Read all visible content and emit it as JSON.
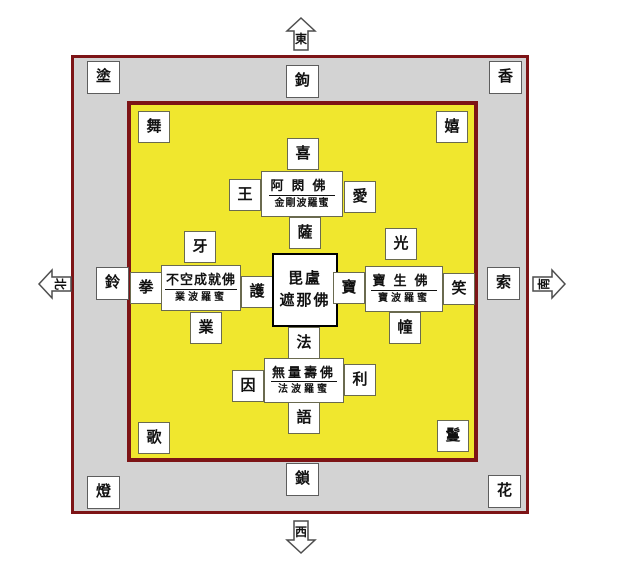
{
  "colors": {
    "courtyard_border": "#7d1416",
    "outer_band_fill": "#d3d3d3",
    "inner_court_fill": "#f0e72e",
    "box_fill": "#ffffff",
    "text": "#111111"
  },
  "compass": {
    "top": "東",
    "bottom": "西",
    "left": "北",
    "right": "南"
  },
  "outer_band": {
    "corner_top_left": "塗",
    "corner_top_right": "香",
    "corner_bottom_left": "燈",
    "corner_bottom_right": "花",
    "edge_top": "鉤",
    "edge_right": "索",
    "edge_bottom": "鎖",
    "edge_left": "鈴"
  },
  "inner_corners": {
    "top_left": "舞",
    "top_right": "嬉",
    "bottom_left": "歌",
    "bottom_right": "鬘"
  },
  "center_buddha": {
    "line1": "毘盧",
    "line2": "遮那佛"
  },
  "buddha_groups": {
    "top": {
      "name": "阿閦佛",
      "paramita": "金剛波羅蜜",
      "satellite_top": "喜",
      "satellite_left": "王",
      "satellite_right": "愛",
      "satellite_bottom": "薩"
    },
    "right": {
      "name": "寶生佛",
      "paramita": "寶波羅蜜",
      "satellite_top": "光",
      "satellite_left": "寶",
      "satellite_right": "笑",
      "satellite_bottom": "幢"
    },
    "bottom": {
      "name": "無量壽佛",
      "paramita": "法波羅蜜",
      "satellite_top": "法",
      "satellite_left": "因",
      "satellite_right": "利",
      "satellite_bottom": "語"
    },
    "left": {
      "name": "不空成就佛",
      "paramita": "業波羅蜜",
      "satellite_top": "牙",
      "satellite_left": "拳",
      "satellite_right": "護",
      "satellite_bottom": "業"
    }
  }
}
